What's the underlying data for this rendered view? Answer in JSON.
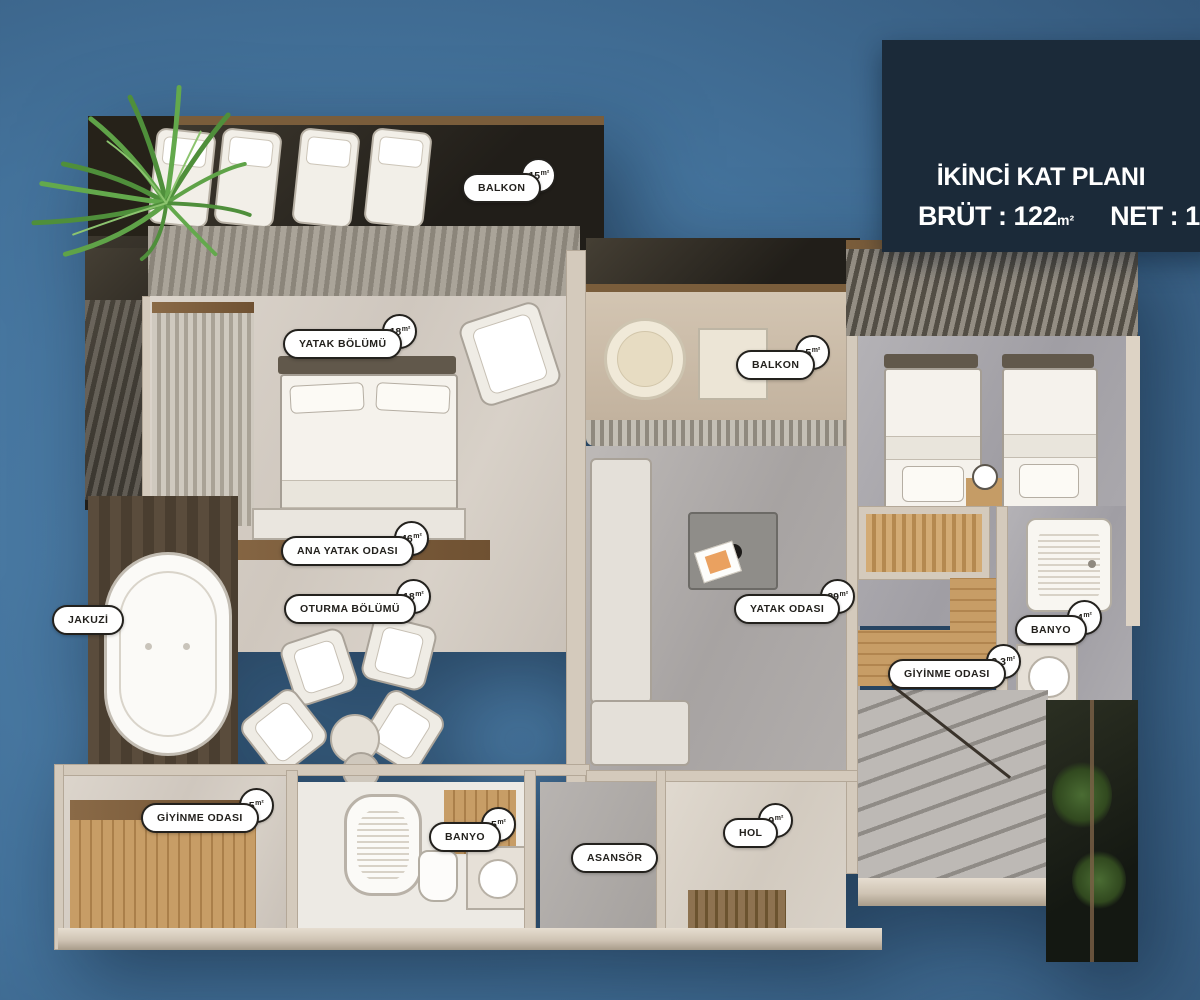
{
  "palette": {
    "background_top": "#2e5070",
    "background_mid": "#4a7aa4",
    "background_bottom": "#294a68",
    "title_box_bg": "#1b2a39",
    "label_ink": "#23211d",
    "label_bg": "#ffffff",
    "wall": "#d4cabc",
    "wood": "#b9895a"
  },
  "title_box": {
    "title": "İKİNCİ KAT PLANI",
    "brut_label": "BRÜT : ",
    "brut_value": "122",
    "brut_unit": "m²",
    "net_label": "NET : ",
    "net_value": "110",
    "net_unit": "m²"
  },
  "labels": [
    {
      "id": "balkon-top",
      "text": "BALKON",
      "area": "15",
      "unit": "m²"
    },
    {
      "id": "yatak-bolumu",
      "text": "YATAK BÖLÜMÜ",
      "area": "18",
      "unit": "m²"
    },
    {
      "id": "balkon-mid",
      "text": "BALKON",
      "area": "5",
      "unit": "m²"
    },
    {
      "id": "ana-yatak-odasi",
      "text": "ANA YATAK ODASI",
      "area": "46",
      "unit": "m²"
    },
    {
      "id": "oturma-bolumu",
      "text": "OTURMA BÖLÜMÜ",
      "area": "18",
      "unit": "m²"
    },
    {
      "id": "jakuzi",
      "text": "JAKUZİ",
      "area": "",
      "unit": ""
    },
    {
      "id": "yatak-odasi",
      "text": "YATAK ODASI",
      "area": "29",
      "unit": "m²"
    },
    {
      "id": "banyo-right",
      "text": "BANYO",
      "area": "4",
      "unit": "m²"
    },
    {
      "id": "giyinme-odasi-right",
      "text": "GİYİNME ODASI",
      "area": "3,3",
      "unit": "m²"
    },
    {
      "id": "giyinme-odasi-left",
      "text": "GİYİNME ODASI",
      "area": "5",
      "unit": "m²"
    },
    {
      "id": "banyo-bottom",
      "text": "BANYO",
      "area": "5",
      "unit": "m²"
    },
    {
      "id": "asansor",
      "text": "ASANSÖR",
      "area": "",
      "unit": ""
    },
    {
      "id": "hol",
      "text": "HOL",
      "area": "9",
      "unit": "m²"
    }
  ]
}
